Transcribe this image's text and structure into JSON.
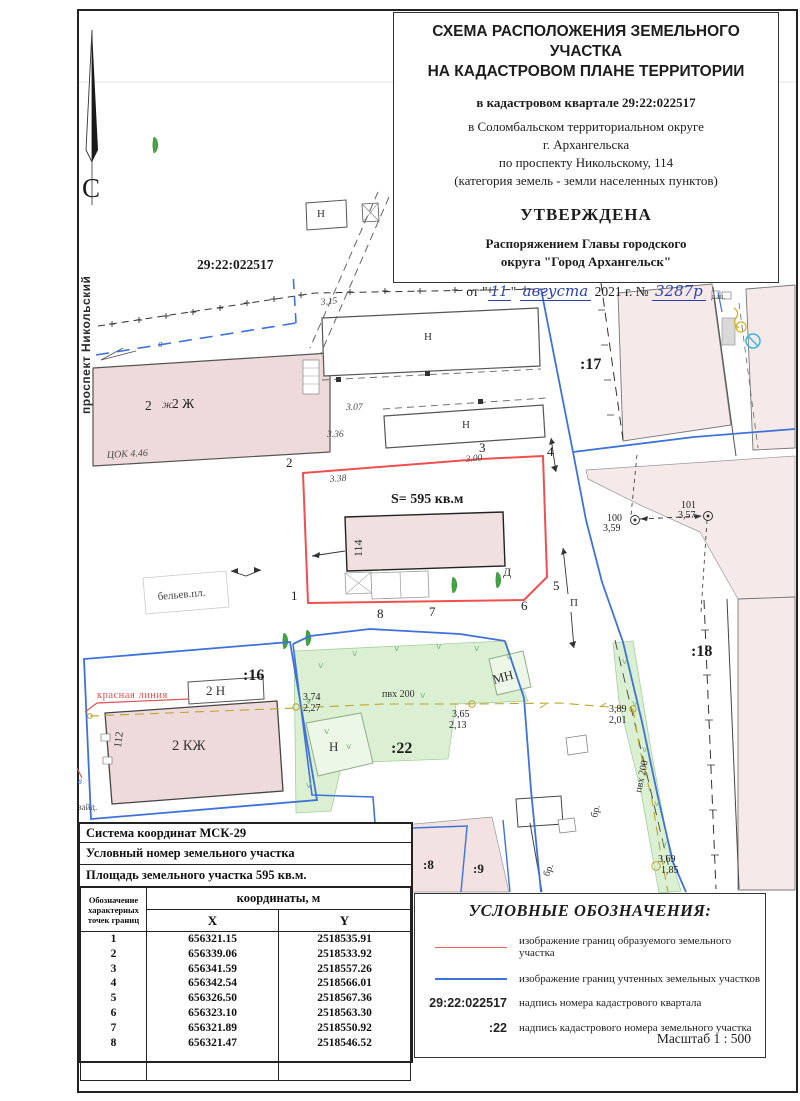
{
  "title_block": {
    "line1": "СХЕМА РАСПОЛОЖЕНИЯ ЗЕМЕЛЬНОГО УЧАСТКА",
    "line2": "НА КАДАСТРОВОМ ПЛАНЕ ТЕРРИТОРИИ",
    "quarter": "в кадастровом квартале 29:22:022517",
    "loc1": "в  Соломбальском территориальном округе",
    "loc2": "г. Архангельска",
    "loc3": "по проспекту Никольскому, 114",
    "loc4": "(категория земель - земли населенных пунктов)",
    "approved": "УТВЕРЖДЕНА",
    "appr1": "Распоряжением Главы городского",
    "appr2": "округа \"Город Архангельск\"",
    "date_prefix": "от \"",
    "date_day": "11",
    "date_mid": "\"",
    "date_month": "августа",
    "date_year": "2021 г. №",
    "date_number": "3287р"
  },
  "table": {
    "header1": "Система координат МСК-29",
    "header2": "Условный номер земельного участка",
    "header3": "Площадь земельного участка  595 кв.м.",
    "col_points": "Обозначение\nхарактерных\nточек границ",
    "col_coords": "координаты, м",
    "col_x": "X",
    "col_y": "Y",
    "points": [
      {
        "n": "1",
        "x": "656321.15",
        "y": "2518535.91"
      },
      {
        "n": "2",
        "x": "656339.06",
        "y": "2518533.92"
      },
      {
        "n": "3",
        "x": "656341.59",
        "y": "2518557.26"
      },
      {
        "n": "4",
        "x": "656342.54",
        "y": "2518566.01"
      },
      {
        "n": "5",
        "x": "656326.50",
        "y": "2518567.36"
      },
      {
        "n": "6",
        "x": "656323.10",
        "y": "2518563.30"
      },
      {
        "n": "7",
        "x": "656321.89",
        "y": "2518550.92"
      },
      {
        "n": "8",
        "x": "656321.47",
        "y": "2518546.52"
      }
    ]
  },
  "legend": {
    "title": "УСЛОВНЫЕ ОБОЗНАЧЕНИЯ:",
    "items": [
      {
        "swatch": "red-line",
        "symbol": "",
        "label": "изображение границ образуемого земельного участка"
      },
      {
        "swatch": "blue-line",
        "symbol": "",
        "label": "изображение границ учтенных земельных участков"
      },
      {
        "swatch": "text",
        "symbol": "29:22:022517",
        "label": "надпись номера кадастрового квартала"
      },
      {
        "swatch": "text",
        "symbol": ":22",
        "label": "надпись кадастрового номера земельного участка"
      }
    ],
    "scale": "Масштаб  1 : 500"
  },
  "colors": {
    "formed_parcel_boundary": "#ef4f4f",
    "registered_parcel_boundary": "#3f72d9",
    "building_fill": "#eedada",
    "vegetation_fill": "#dbf0d3",
    "utility_line": "#b9a52b",
    "handwriting_ink": "#2b3fae"
  },
  "map": {
    "labels": [
      {
        "name": "north-letter",
        "text": "С",
        "x": 82,
        "y": 197,
        "cls": "north"
      },
      {
        "name": "street-name",
        "text": "проспект Никольский",
        "x": 90,
        "y": 414,
        "cls": "street",
        "rot": -90
      },
      {
        "name": "cadastral-quarter-number",
        "text": "29:22:022517",
        "x": 197,
        "y": 269,
        "cls": "qnum"
      },
      {
        "name": "building-2zh-number",
        "text": "2",
        "x": 145,
        "y": 410,
        "cls": "h14"
      },
      {
        "name": "building-2zh-hand-mark",
        "text": "ж",
        "x": 162,
        "y": 408,
        "cls": "hand12"
      },
      {
        "name": "building-2zh-label",
        "text": "2 Ж",
        "x": 172,
        "y": 408,
        "cls": "h14"
      },
      {
        "name": "hand-mark-cok",
        "text": "ЦОК 4.46",
        "x": 107,
        "y": 458,
        "cls": "hand10",
        "rot": -3
      },
      {
        "name": "hand-mark-elev",
        "text": "3,15",
        "x": 321,
        "y": 305,
        "cls": "hand9",
        "rot": -6
      },
      {
        "name": "hand-mark-elev",
        "text": "3.07",
        "x": 346,
        "y": 410,
        "cls": "hand9"
      },
      {
        "name": "hand-mark-elev",
        "text": "3.36",
        "x": 327,
        "y": 437,
        "cls": "hand9"
      },
      {
        "name": "hand-mark-elev",
        "text": "3.38",
        "x": 330,
        "y": 482,
        "cls": "hand9",
        "rot": -5
      },
      {
        "name": "hand-mark-elev",
        "text": "3.00",
        "x": 466,
        "y": 462,
        "cls": "hand9",
        "rot": -6
      },
      {
        "name": "vertex-1",
        "text": "1",
        "x": 291,
        "y": 600,
        "cls": "vertex"
      },
      {
        "name": "vertex-2",
        "text": "2",
        "x": 286,
        "y": 467,
        "cls": "vertex"
      },
      {
        "name": "vertex-3",
        "text": "3",
        "x": 479,
        "y": 452,
        "cls": "vertex"
      },
      {
        "name": "vertex-4",
        "text": "4",
        "x": 547,
        "y": 456,
        "cls": "vertex"
      },
      {
        "name": "vertex-5",
        "text": "5",
        "x": 553,
        "y": 590,
        "cls": "vertex"
      },
      {
        "name": "vertex-6",
        "text": "6",
        "x": 521,
        "y": 610,
        "cls": "vertex"
      },
      {
        "name": "vertex-7",
        "text": "7",
        "x": 429,
        "y": 616,
        "cls": "vertex"
      },
      {
        "name": "vertex-8",
        "text": "8",
        "x": 377,
        "y": 618,
        "cls": "vertex"
      },
      {
        "name": "parcel-area-label",
        "text": "S= 595 кв.м",
        "x": 391,
        "y": 503,
        "cls": "area"
      },
      {
        "name": "building-114-label",
        "text": "114",
        "x": 362,
        "y": 557,
        "cls": "h12",
        "rot": -90
      },
      {
        "name": "point-d-label",
        "text": "Д",
        "x": 503,
        "y": 576,
        "cls": "h12"
      },
      {
        "name": "building-n-label",
        "text": "Н",
        "x": 317,
        "y": 217,
        "cls": "h11"
      },
      {
        "name": "building-n-label",
        "text": "Н",
        "x": 424,
        "y": 340,
        "cls": "h11"
      },
      {
        "name": "building-n-label",
        "text": "Н",
        "x": 462,
        "y": 428,
        "cls": "h11"
      },
      {
        "name": "building-n-label",
        "text": "Н",
        "x": 329,
        "y": 751,
        "cls": "h13"
      },
      {
        "name": "building-mn-label",
        "text": "МН",
        "x": 494,
        "y": 684,
        "cls": "h13",
        "rot": -15
      },
      {
        "name": "parcel-17-label",
        "text": ":17",
        "x": 580,
        "y": 369,
        "cls": "pnum"
      },
      {
        "name": "parcel-18-label",
        "text": ":18",
        "x": 691,
        "y": 656,
        "cls": "pnum"
      },
      {
        "name": "parcel-16-label",
        "text": ":16",
        "x": 243,
        "y": 680,
        "cls": "pnum"
      },
      {
        "name": "parcel-22-label",
        "text": ":22",
        "x": 391,
        "y": 753,
        "cls": "pnum"
      },
      {
        "name": "parcel-8-label",
        "text": ":8",
        "x": 423,
        "y": 869,
        "cls": "pnum-s"
      },
      {
        "name": "parcel-9-label",
        "text": ":9",
        "x": 473,
        "y": 873,
        "cls": "pnum-s"
      },
      {
        "name": "red-line-label",
        "text": "красная линия",
        "x": 97,
        "y": 698,
        "cls": "redlbl"
      },
      {
        "name": "building-2n-label",
        "text": "2 Н",
        "x": 206,
        "y": 695,
        "cls": "h13"
      },
      {
        "name": "building-2kzh-label",
        "text": "2 КЖ",
        "x": 172,
        "y": 750,
        "cls": "h15"
      },
      {
        "name": "building-112-label",
        "text": "112",
        "x": 121,
        "y": 748,
        "cls": "h11",
        "rot": -83
      },
      {
        "name": "drying-area-label",
        "text": "бельев.пл.",
        "x": 158,
        "y": 600,
        "cls": "h11g",
        "rot": -5
      },
      {
        "name": "utility-pvc-label",
        "text": "пвх 200",
        "x": 382,
        "y": 697,
        "cls": "small10"
      },
      {
        "name": "utility-pvc-label",
        "text": "пвх 200",
        "x": 641,
        "y": 793,
        "cls": "small10",
        "rot": -78
      },
      {
        "name": "elevation-value",
        "text": "3,74",
        "x": 303,
        "y": 700,
        "cls": "num10"
      },
      {
        "name": "elevation-value",
        "text": "2,27",
        "x": 303,
        "y": 711,
        "cls": "num10"
      },
      {
        "name": "elevation-value",
        "text": "3,65",
        "x": 452,
        "y": 717,
        "cls": "num10"
      },
      {
        "name": "elevation-value",
        "text": "2,13",
        "x": 449,
        "y": 728,
        "cls": "num10"
      },
      {
        "name": "elevation-value",
        "text": "3,89",
        "x": 609,
        "y": 712,
        "cls": "num10"
      },
      {
        "name": "elevation-value",
        "text": "2,01",
        "x": 609,
        "y": 723,
        "cls": "num10"
      },
      {
        "name": "elevation-value",
        "text": "3,69",
        "x": 658,
        "y": 862,
        "cls": "num10"
      },
      {
        "name": "elevation-value",
        "text": "1,85",
        "x": 661,
        "y": 873,
        "cls": "num10"
      },
      {
        "name": "benchmark-number",
        "text": "100",
        "x": 607,
        "y": 521,
        "cls": "num10"
      },
      {
        "name": "benchmark-value",
        "text": "3,59",
        "x": 603,
        "y": 531,
        "cls": "num10"
      },
      {
        "name": "benchmark-number",
        "text": "101",
        "x": 681,
        "y": 508,
        "cls": "num10"
      },
      {
        "name": "benchmark-value",
        "text": "3,57",
        "x": 678,
        "y": 518,
        "cls": "num10"
      },
      {
        "name": "pavement-label",
        "text": "бр.",
        "x": 549,
        "y": 877,
        "cls": "small10",
        "rot": -70
      },
      {
        "name": "pavement-label",
        "text": "бр.",
        "x": 597,
        "y": 818,
        "cls": "small10",
        "rot": -77
      },
      {
        "name": "water-line-label",
        "text": "в",
        "x": 158,
        "y": 347,
        "cls": "bluelbl"
      },
      {
        "name": "water-line-label",
        "text": "в",
        "x": 78,
        "y": 784,
        "cls": "bluelbl-s"
      },
      {
        "name": "edge-note",
        "text": "зайд.",
        "x": 78,
        "y": 810,
        "cls": "small9"
      },
      {
        "name": "pole-symbol-label",
        "text": "П",
        "x": 570,
        "y": 606,
        "cls": "h11"
      },
      {
        "name": "edge-note",
        "text": "д.ш.",
        "x": 711,
        "y": 299,
        "cls": "small8"
      },
      {
        "name": "grass-mark",
        "text": "v",
        "x": 318,
        "y": 668,
        "cls": "grass"
      },
      {
        "name": "grass-mark",
        "text": "v",
        "x": 352,
        "y": 656,
        "cls": "grass"
      },
      {
        "name": "grass-mark",
        "text": "v",
        "x": 394,
        "y": 651,
        "cls": "grass"
      },
      {
        "name": "grass-mark",
        "text": "v",
        "x": 436,
        "y": 649,
        "cls": "grass"
      },
      {
        "name": "grass-mark",
        "text": "v",
        "x": 474,
        "y": 651,
        "cls": "grass"
      },
      {
        "name": "grass-mark",
        "text": "v",
        "x": 506,
        "y": 659,
        "cls": "grass"
      },
      {
        "name": "grass-mark",
        "text": "v",
        "x": 306,
        "y": 704,
        "cls": "grass"
      },
      {
        "name": "grass-mark",
        "text": "v",
        "x": 324,
        "y": 734,
        "cls": "grass"
      },
      {
        "name": "grass-mark",
        "text": "v",
        "x": 346,
        "y": 749,
        "cls": "grass"
      },
      {
        "name": "grass-mark",
        "text": "v",
        "x": 306,
        "y": 788,
        "cls": "grass"
      },
      {
        "name": "grass-mark",
        "text": "v",
        "x": 622,
        "y": 664,
        "cls": "grass"
      },
      {
        "name": "grass-mark",
        "text": "v",
        "x": 632,
        "y": 706,
        "cls": "grass"
      },
      {
        "name": "grass-mark",
        "text": "v",
        "x": 642,
        "y": 752,
        "cls": "grass"
      },
      {
        "name": "grass-mark",
        "text": "v",
        "x": 654,
        "y": 806,
        "cls": "grass"
      },
      {
        "name": "grass-mark",
        "text": "v",
        "x": 662,
        "y": 846,
        "cls": "grass"
      },
      {
        "name": "grass-mark",
        "text": "v",
        "x": 420,
        "y": 698,
        "cls": "grass"
      }
    ]
  }
}
